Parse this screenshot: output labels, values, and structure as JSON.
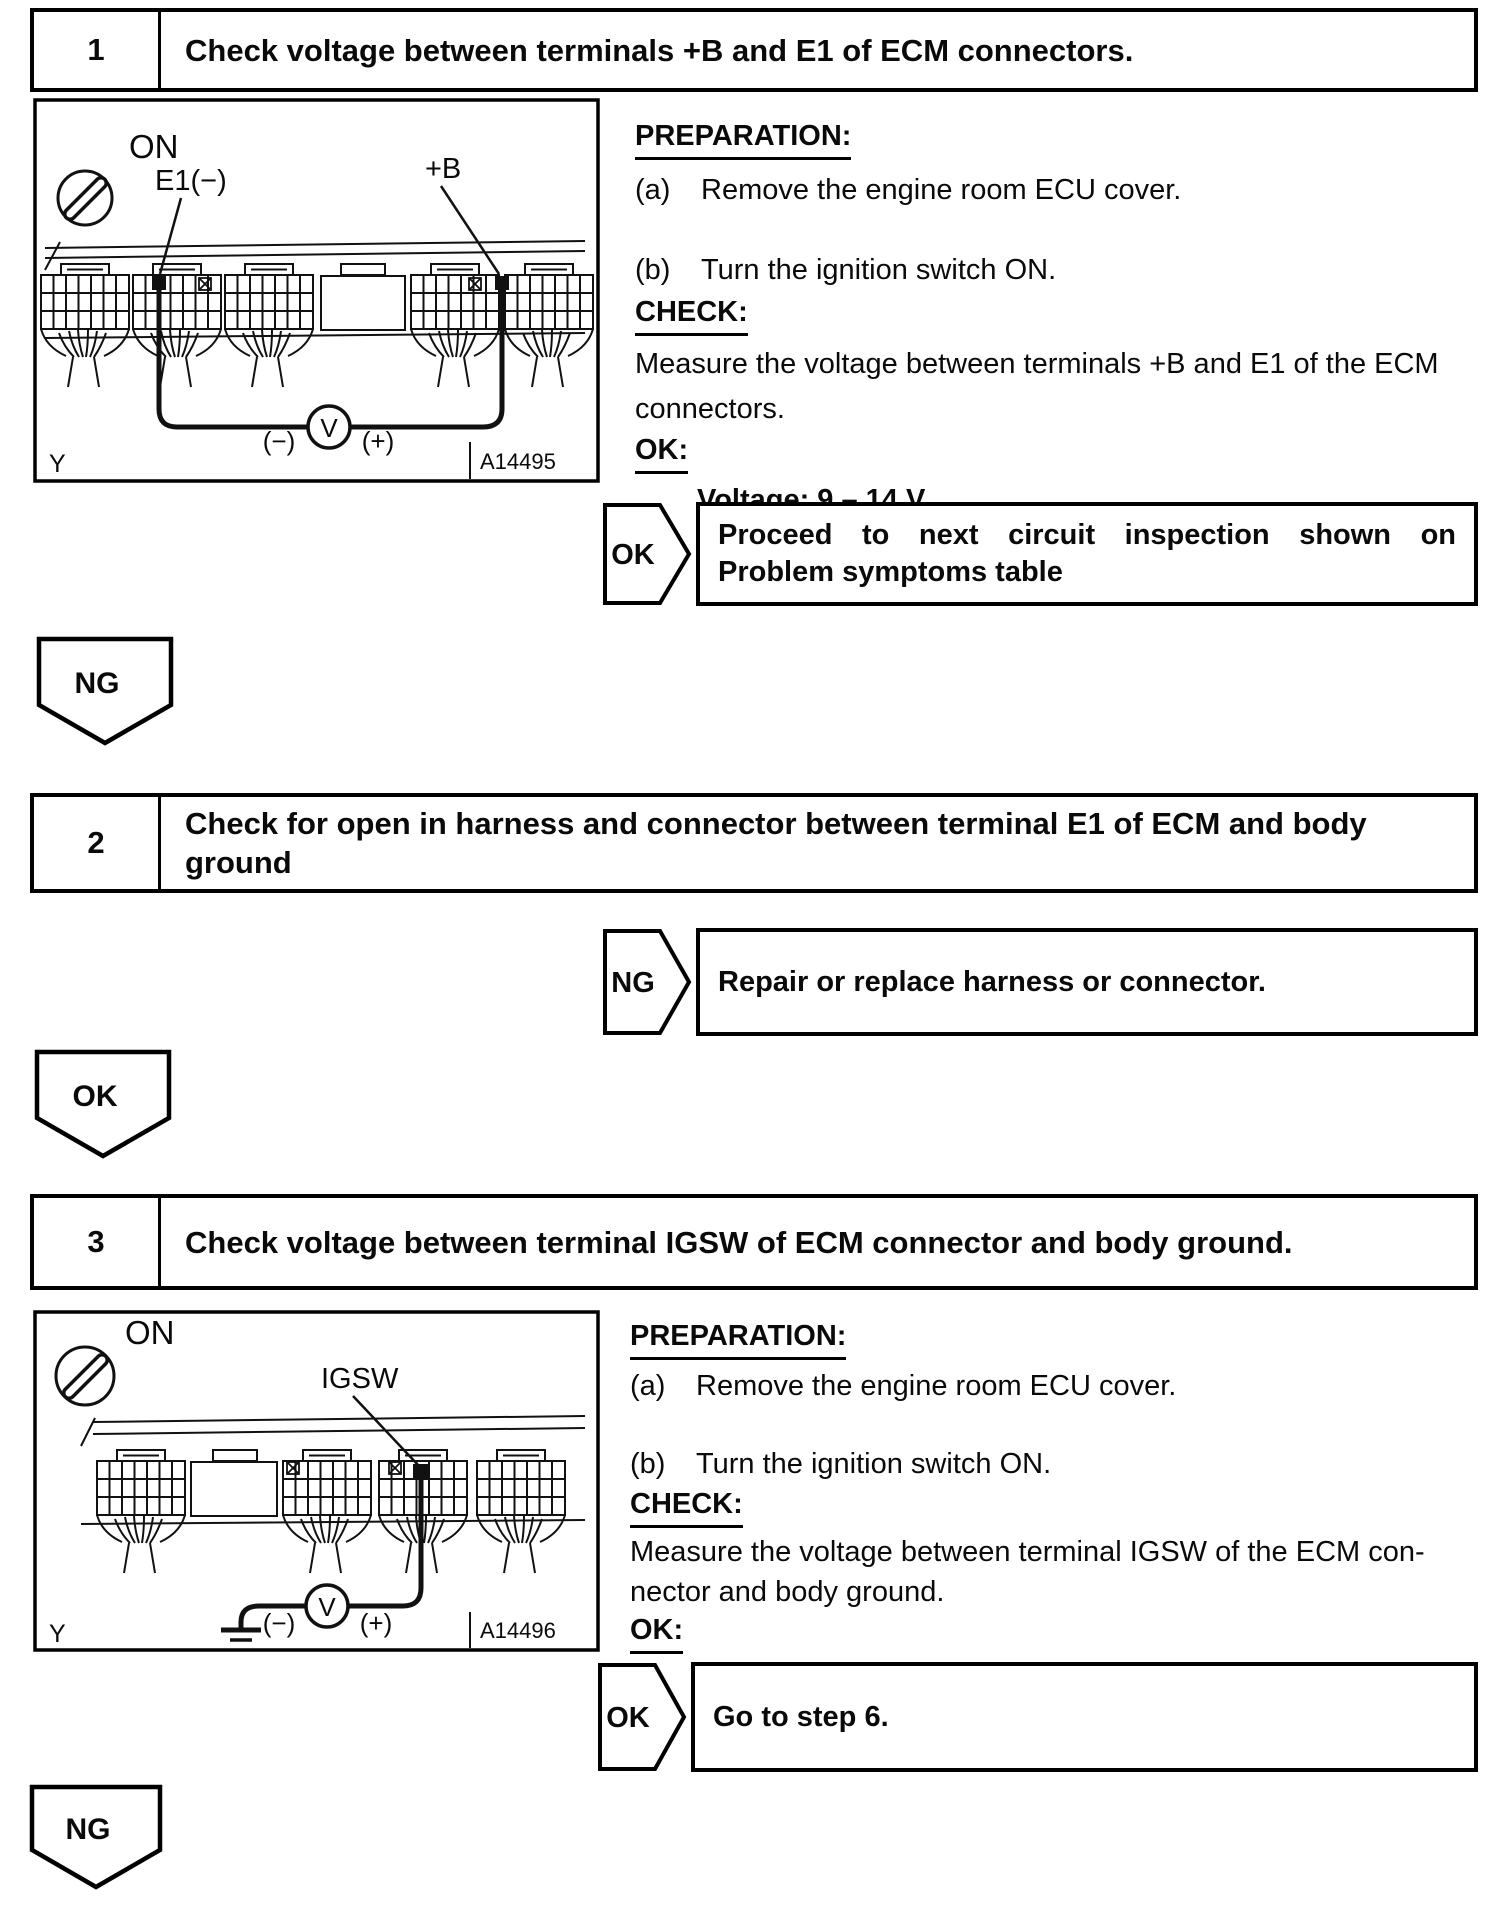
{
  "steps": [
    {
      "number": "1",
      "title_lines": [
        "Check voltage between terminals +B and E1 of ECM connectors."
      ],
      "figure": {
        "ignition_state": "ON",
        "terminal_negative": "E1(−)",
        "terminal_positive": "+B",
        "meter_symbol": "V",
        "meter_negative": "(−)",
        "meter_positive": "(+)",
        "corner_mark": "Y",
        "figure_id": "A14495"
      },
      "preparation": {
        "heading": "PREPARATION:",
        "items": [
          {
            "marker": "(a)",
            "text": "Remove the engine room ECU cover."
          },
          {
            "marker": "(b)",
            "text": "Turn the ignition switch ON."
          }
        ]
      },
      "check": {
        "heading": "CHECK:",
        "lines": [
          "Measure the voltage between terminals +B and E1 of the ECM",
          "connectors."
        ]
      },
      "ok_spec": {
        "heading": "OK:",
        "value": "Voltage: 9 – 14 V"
      },
      "result": {
        "badge": "OK",
        "lines": [
          "Proceed to next circuit inspection shown on",
          "Problem symptoms table"
        ]
      },
      "next_branch": "NG"
    },
    {
      "number": "2",
      "title_lines": [
        "Check for open in harness and connector between terminal E1 of ECM and body",
        "ground"
      ],
      "result": {
        "badge": "NG",
        "lines": [
          "Repair or replace harness or connector."
        ]
      },
      "next_branch": "OK"
    },
    {
      "number": "3",
      "title_lines": [
        "Check voltage between terminal IGSW of ECM connector and body ground."
      ],
      "figure": {
        "ignition_state": "ON",
        "terminal_signal": "IGSW",
        "meter_symbol": "V",
        "meter_negative": "(−)",
        "meter_positive": "(+)",
        "corner_mark": "Y",
        "figure_id": "A14496"
      },
      "preparation": {
        "heading": "PREPARATION:",
        "items": [
          {
            "marker": "(a)",
            "text": "Remove the engine room ECU cover."
          },
          {
            "marker": "(b)",
            "text": "Turn the ignition switch ON."
          }
        ]
      },
      "check": {
        "heading": "CHECK:",
        "lines": [
          "Measure the voltage between terminal IGSW of the ECM con-",
          "nector and body ground."
        ]
      },
      "ok_spec": {
        "heading": "OK:",
        "value": "Voltage: 9 – 14 V"
      },
      "result": {
        "badge": "OK",
        "lines": [
          "Go to step 6."
        ]
      },
      "next_branch": "NG"
    }
  ]
}
